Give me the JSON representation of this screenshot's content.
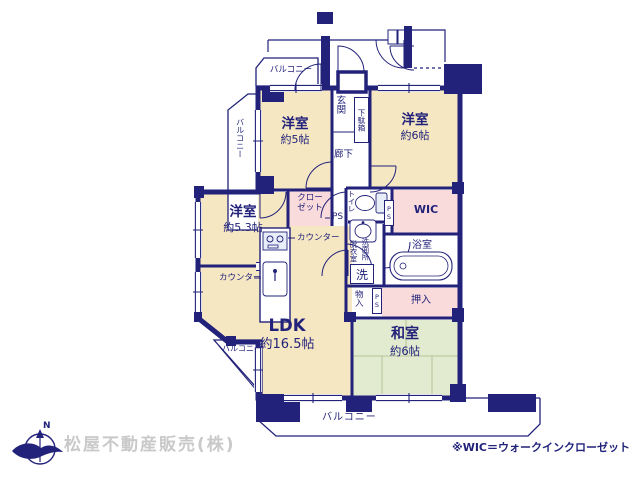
{
  "colors": {
    "wall_navy": "#22227a",
    "room_cream": "#f6e7c3",
    "tatami_green": "#e2eacf",
    "closet_pink": "#f9dbdb",
    "fixture_blue": "#e7eef8",
    "company_gray": "#c9c9c9"
  },
  "rooms": [
    {
      "name": "洋室",
      "size": "約5帖"
    },
    {
      "name": "洋室",
      "size": "約6帖"
    },
    {
      "name": "洋室",
      "size": "約5.3帖"
    },
    {
      "name": "LDK",
      "size": "約16.5帖"
    },
    {
      "name": "和室",
      "size": "約6帖"
    }
  ],
  "labels": {
    "balcony": "バルコニー",
    "genkan": "玄関",
    "getabako": "下駄箱",
    "rouka": "廊下",
    "closet1": "クロー",
    "closet2": "ゼット",
    "ps": "PS",
    "toilet": "トイレ",
    "wic": "WIC",
    "datsuishitsu": "脱衣室",
    "senmenjo": "洗面所",
    "laundry": "洗",
    "bath": "浴室",
    "monoire": "物入",
    "oshiire": "押入",
    "counter": "カウンター"
  },
  "footer": {
    "compass_n": "N",
    "company": "松屋不動産販売(株)",
    "note": "※WIC＝ウォークインクローゼット"
  }
}
